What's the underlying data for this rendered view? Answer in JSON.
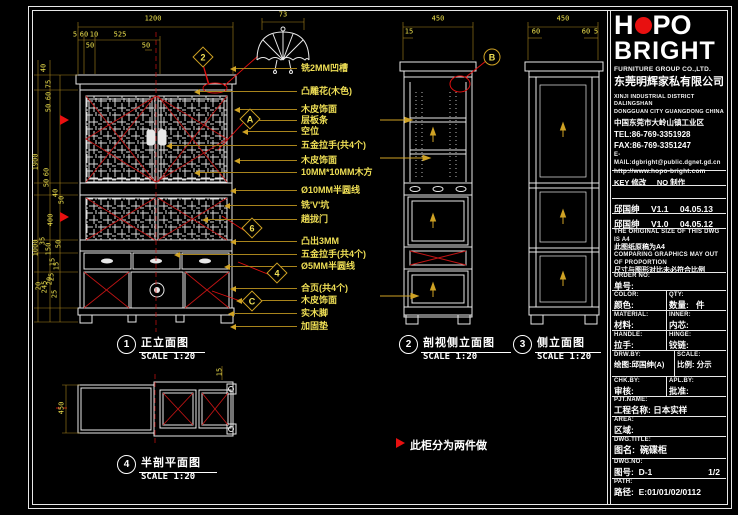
{
  "logo": {
    "h": "H",
    "po": "PO",
    "bright": "BRIGHT",
    "sub": "FURNITURE GROUP CO.,LTD.",
    "cn": "东莞明辉家私有限公司",
    "addr1": "XINJI INDUSTRIAL DISTRICT DALINGSHAN",
    "addr2": "DONGGUAN CITY GUANGDONG CHINA",
    "addr_cn": "中国东莞市大岭山镇工业区",
    "tel": "TEL:86-769-3351928",
    "fax": "FAX:86-769-3351247",
    "email": "E-MAIL:dgbright@public.dgnet.gd.cn",
    "web": "http://www.hopo-bright.com"
  },
  "tb": {
    "rev_key": "KEY 修改",
    "rev_no": "NO 制作",
    "rev_date": "DATE 日期",
    "rev1_by": "邱国绅",
    "rev1_ver": "V1.1",
    "rev1_date": "04.05.13",
    "rev2_by": "邱国绅",
    "rev2_ver": "V1.0",
    "rev2_date": "04.05.12",
    "note1": "THE ORIGINAL SIZE OF THIS DWG IS A4",
    "note2": "此图纸原稿为A4",
    "note3": "COMPARING GRAPHICS MAY OUT",
    "note4": "OF PROPORTION",
    "note5": "尺寸与图形对比未必符合比例",
    "order_en": "ORDER NO:",
    "order_cn": "单号:",
    "color_en": "COLOR:",
    "color_cn": "颜色:",
    "qty_en": "QTY:",
    "qty_cn": "数量:",
    "qty_unit": "件",
    "material_en": "MATERIAL:",
    "material_cn": "材料:",
    "inner_en": "INNER:",
    "inner_cn": "内芯:",
    "handle_en": "HANDLE:",
    "handle_cn": "拉手:",
    "hinge_en": "HINGE:",
    "hinge_cn": "铰链:",
    "drw_en": "DRW.BY:",
    "drw_cn": "绘图:",
    "drw_val": "邱国绅(A)",
    "scale_en": "SCALE:",
    "scale_cn": "比例:",
    "scale_val": "分示",
    "chk_en": "CHK.BY:",
    "chk_cn": "审核:",
    "apl_en": "APL.BY:",
    "apl_cn": "批准:",
    "pjt_en": "PJT.NAME:",
    "pjt_cn": "工程名称:",
    "pjt_val": "日本实样",
    "area_en": "AREA:",
    "area_cn": "区域:",
    "title_en": "DWG.TITLE:",
    "title_cn": "图名:",
    "title_val": "碗碟柜",
    "no_en": "DWG.NO:",
    "no_cn": "图号:",
    "no_val": "D-1",
    "sheet": "1/2",
    "path_en": "PATH:",
    "path_cn": "路径:",
    "path_val": "E:01/01/02/0112"
  },
  "views": [
    {
      "num": "1",
      "title": "正立面图",
      "scale": "SCALE 1:20"
    },
    {
      "num": "2",
      "title": "剖视侧立面图",
      "scale": "SCALE 1:20"
    },
    {
      "num": "3",
      "title": "侧立面图",
      "scale": "SCALE 1:20"
    },
    {
      "num": "4",
      "title": "半剖平面图",
      "scale": "SCALE 1:20"
    }
  ],
  "note": {
    "text": "此柜分为两件做"
  },
  "callouts": [
    {
      "t": "铣2MM凹槽",
      "y": 64,
      "lx": 232
    },
    {
      "t": "凸雕花(木色)",
      "y": 87,
      "lx": 196
    },
    {
      "t": "木皮饰面",
      "y": 105,
      "lx": 236
    },
    {
      "t": "层板条",
      "y": 116,
      "lx": 244
    },
    {
      "t": "空位",
      "y": 127,
      "lx": 244
    },
    {
      "t": "五金拉手(共4个)",
      "y": 141,
      "lx": 168
    },
    {
      "t": "木皮饰面",
      "y": 156,
      "lx": 236
    },
    {
      "t": "10MM*10MM木方",
      "y": 168,
      "lx": 196
    },
    {
      "t": "Ø10MM半圆线",
      "y": 186,
      "lx": 232
    },
    {
      "t": "铣'V'坑",
      "y": 201,
      "lx": 226
    },
    {
      "t": "趟拢门",
      "y": 215,
      "lx": 204
    },
    {
      "t": "凸出3MM",
      "y": 237,
      "lx": 232
    },
    {
      "t": "五金拉手(共4个)",
      "y": 250,
      "lx": 176
    },
    {
      "t": "Ø5MM半圆线",
      "y": 262,
      "lx": 226
    },
    {
      "t": "合页(共4个)",
      "y": 284,
      "lx": 232
    },
    {
      "t": "木皮饰面",
      "y": 296,
      "lx": 238
    },
    {
      "t": "实木脚",
      "y": 309,
      "lx": 230
    },
    {
      "t": "加固垫",
      "y": 322,
      "lx": 232
    }
  ],
  "dims": [
    {
      "t": "1200",
      "x": 153,
      "y": 19,
      "r": 0
    },
    {
      "t": "5",
      "x": 75,
      "y": 35,
      "r": 0
    },
    {
      "t": "60",
      "x": 84,
      "y": 35,
      "r": 0
    },
    {
      "t": "10",
      "x": 94,
      "y": 35,
      "r": 0
    },
    {
      "t": "525",
      "x": 120,
      "y": 35,
      "r": 0
    },
    {
      "t": "50",
      "x": 90,
      "y": 46,
      "r": 0
    },
    {
      "t": "50",
      "x": 146,
      "y": 46,
      "r": 0
    },
    {
      "t": "73",
      "x": 283,
      "y": 15,
      "r": 0
    },
    {
      "t": "40",
      "x": 44,
      "y": 68,
      "r": 90
    },
    {
      "t": "75",
      "x": 49,
      "y": 84,
      "r": 90
    },
    {
      "t": "60",
      "x": 49,
      "y": 96,
      "r": 90
    },
    {
      "t": "50",
      "x": 49,
      "y": 108,
      "r": 90
    },
    {
      "t": "1900",
      "x": 36,
      "y": 162,
      "r": 90
    },
    {
      "t": "60",
      "x": 47,
      "y": 172,
      "r": 90
    },
    {
      "t": "50",
      "x": 47,
      "y": 183,
      "r": 90
    },
    {
      "t": "40",
      "x": 56,
      "y": 193,
      "r": 90
    },
    {
      "t": "50",
      "x": 62,
      "y": 200,
      "r": 90
    },
    {
      "t": "400",
      "x": 51,
      "y": 220,
      "r": 90
    },
    {
      "t": "35",
      "x": 43,
      "y": 241,
      "r": 90
    },
    {
      "t": "150",
      "x": 49,
      "y": 249,
      "r": 90
    },
    {
      "t": "50",
      "x": 59,
      "y": 244,
      "r": 90
    },
    {
      "t": "1000",
      "x": 36,
      "y": 248,
      "r": 90
    },
    {
      "t": "15",
      "x": 53,
      "y": 262,
      "r": 90
    },
    {
      "t": "15",
      "x": 57,
      "y": 266,
      "r": 90
    },
    {
      "t": "25",
      "x": 52,
      "y": 277,
      "r": 90
    },
    {
      "t": "20",
      "x": 39,
      "y": 286,
      "r": 90
    },
    {
      "t": "245",
      "x": 45,
      "y": 287,
      "r": 90
    },
    {
      "t": "20",
      "x": 50,
      "y": 281,
      "r": 90
    },
    {
      "t": "25",
      "x": 55,
      "y": 294,
      "r": 90
    },
    {
      "t": "450",
      "x": 438,
      "y": 19,
      "r": 0
    },
    {
      "t": "15",
      "x": 409,
      "y": 32,
      "r": 0
    },
    {
      "t": "450",
      "x": 563,
      "y": 19,
      "r": 0
    },
    {
      "t": "60",
      "x": 536,
      "y": 32,
      "r": 0
    },
    {
      "t": "60",
      "x": 586,
      "y": 32,
      "r": 0
    },
    {
      "t": "5",
      "x": 596,
      "y": 32,
      "r": 0
    },
    {
      "t": "450",
      "x": 62,
      "y": 408,
      "r": 90
    },
    {
      "t": "15",
      "x": 220,
      "y": 372,
      "r": 90
    }
  ],
  "markers": [
    {
      "t": "2",
      "x": 203,
      "y": 57,
      "shape": "diamond"
    },
    {
      "t": "A",
      "x": 250,
      "y": 119,
      "shape": "diamond"
    },
    {
      "t": "6",
      "x": 252,
      "y": 228,
      "shape": "diamond"
    },
    {
      "t": "4",
      "x": 277,
      "y": 273,
      "shape": "diamond"
    },
    {
      "t": "C",
      "x": 252,
      "y": 301,
      "shape": "diamond"
    },
    {
      "t": "B",
      "x": 492,
      "y": 57,
      "shape": "circle"
    }
  ],
  "colors": {
    "dim_text": "#efe24e",
    "leader": "#a8841c",
    "red": "#e01010",
    "line": "#e8e8e8"
  }
}
